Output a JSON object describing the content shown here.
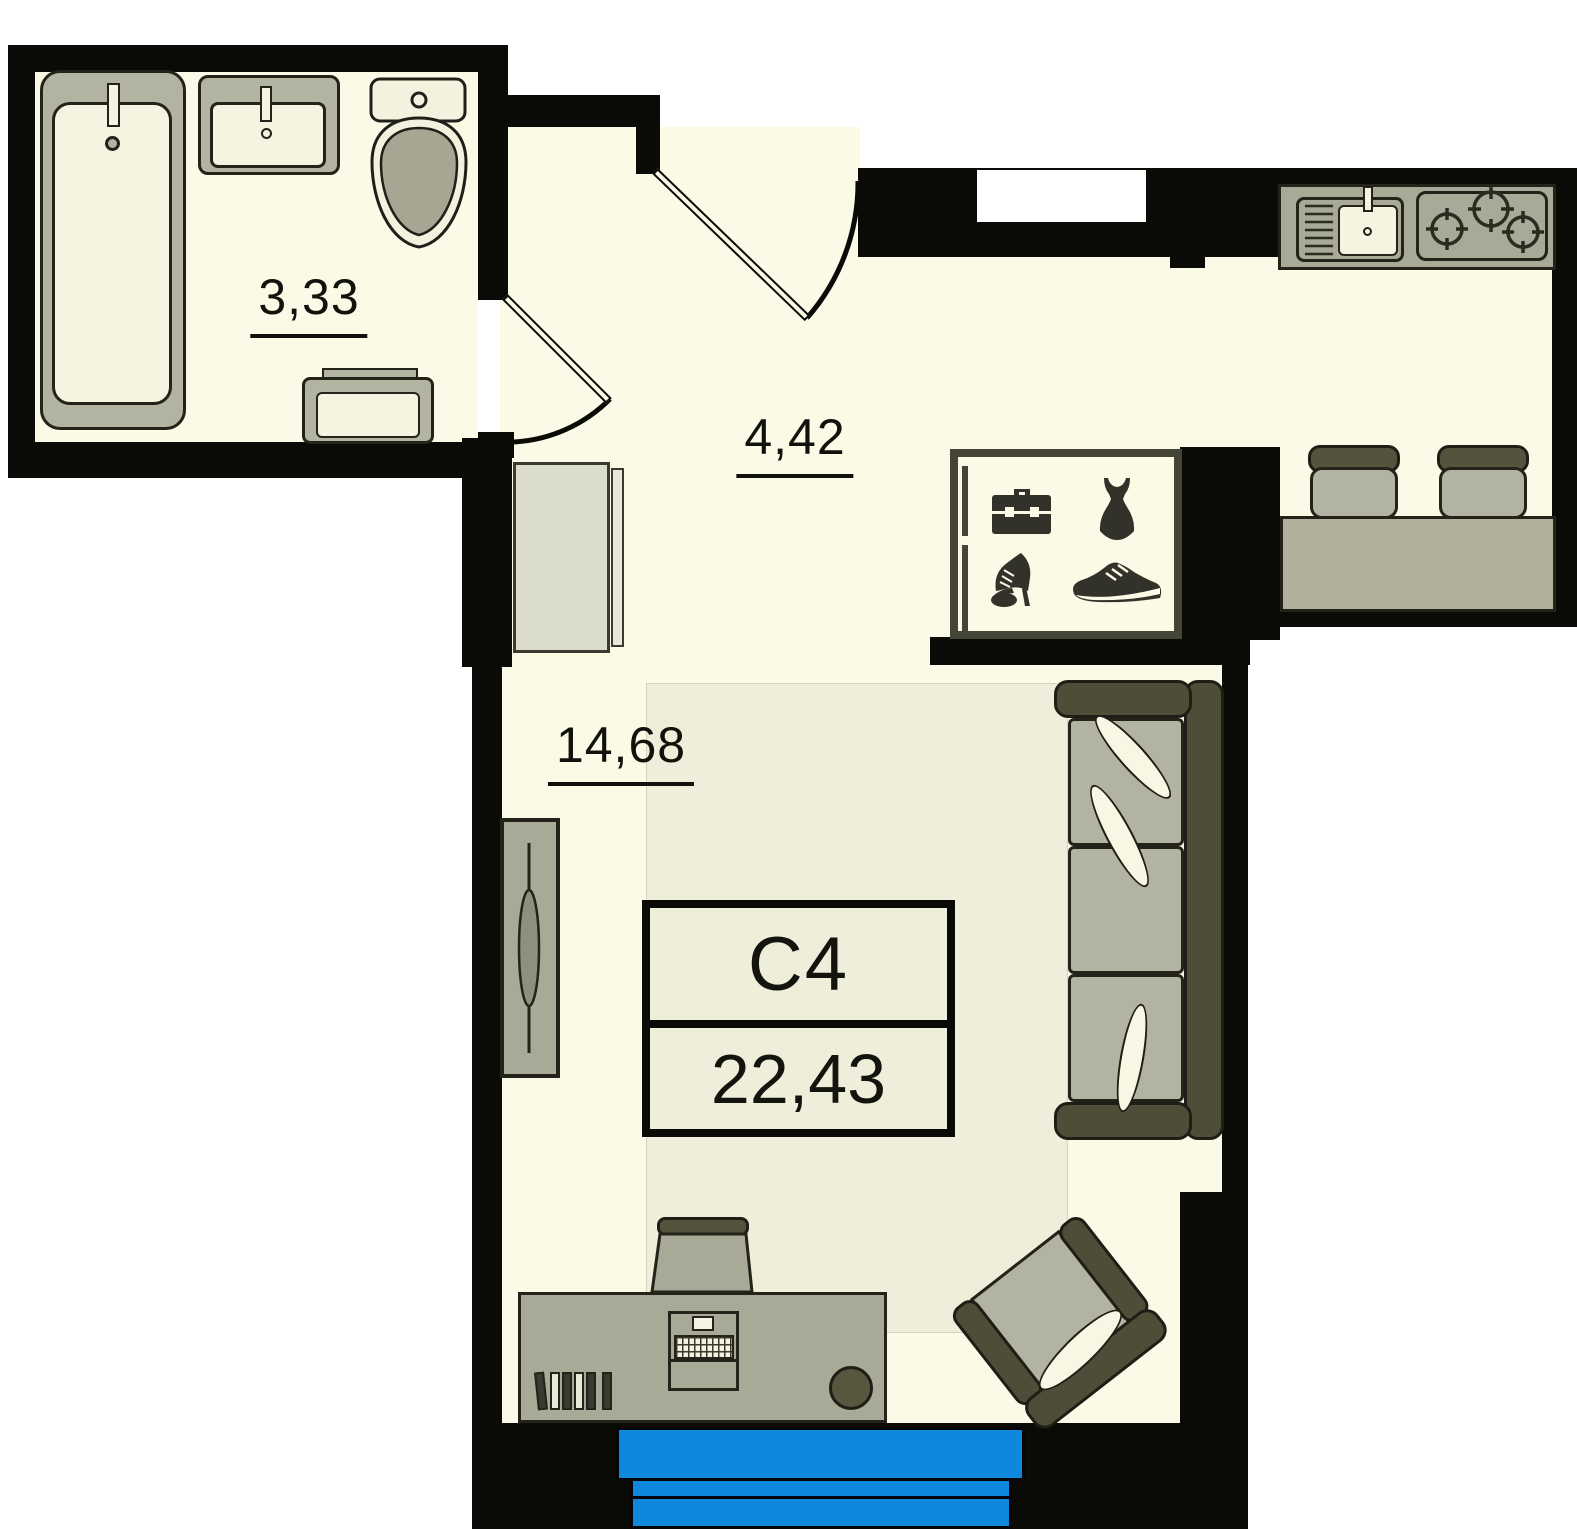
{
  "plan_title": "studio apartment floor plan",
  "unit": {
    "label": "С4",
    "area": "22,43"
  },
  "rooms": [
    {
      "name": "bathroom",
      "area": "3,33"
    },
    {
      "name": "hallway",
      "area": "4,42"
    },
    {
      "name": "living-room",
      "area": "14,68"
    }
  ],
  "wardrobe_icons": [
    "briefcase-icon",
    "dress-icon",
    "heel-shoe-icon",
    "sneaker-icon"
  ],
  "fixtures": [
    "bathtub",
    "washbasin",
    "toilet",
    "washing-machine",
    "kitchen-sink",
    "stove",
    "bar-counter",
    "bar-stool",
    "bar-stool",
    "wardrobe",
    "cabinet",
    "tv-stand",
    "sofa",
    "armchair",
    "desk",
    "desk-chair",
    "laptop",
    "books",
    "balcony-window"
  ],
  "colors": {
    "wall": "#0a0a07",
    "floor": "#fafae6",
    "rug": "#eeeeda",
    "furniture_gray": "#a9a997",
    "seat_gray": "#b3b3a1",
    "dark_olive": "#4e4e38",
    "fixture_cream": "#f4f4e0",
    "balcony_blue": "#0e87dc",
    "icon_dark": "#32322a"
  }
}
